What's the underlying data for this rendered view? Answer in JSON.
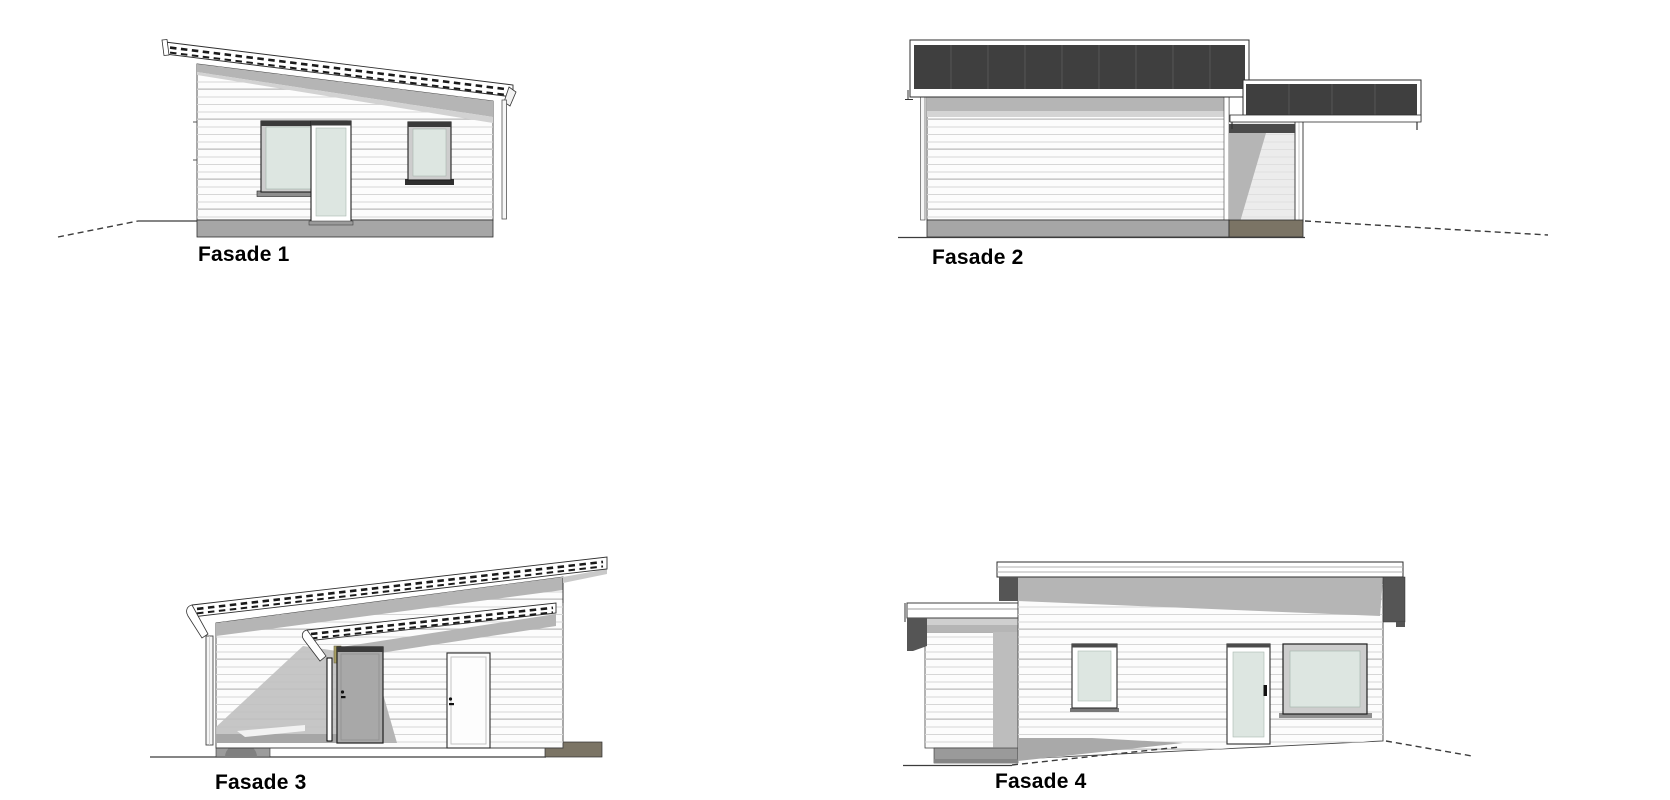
{
  "facades": [
    {
      "id": "fasade-1",
      "label": "Fasade 1",
      "view": "front elevation: mono-pitch roof sloping down to the right, large window, glazed door, small window, ground line falling away to the left"
    },
    {
      "id": "fasade-2",
      "label": "Fasade 2",
      "view": "side elevation: dark flat roof band, closed siding wall, attached carport with corner post at the right, ground line falling away to the right"
    },
    {
      "id": "fasade-3",
      "label": "Fasade 3",
      "view": "rear elevation: shed roof rising to the right, open carport with post at the left, grey entrance door and white door under a lower porch roof"
    },
    {
      "id": "fasade-4",
      "label": "Fasade 4",
      "view": "side elevation: attached carport at the left, small window, glazed door, large window, terrace slab in front"
    }
  ],
  "colors": {
    "background": "#ffffff",
    "wall": "#fcfcfc",
    "siding_line": "#d6d6d6",
    "roof_dark": "#3f3f3f",
    "shadow_grey": "#b5b5b5",
    "carport_shadow": "#c0c0c0",
    "plinth_grey": "#a6a6a6",
    "plinth_brown": "#7b7465",
    "glass_green": "#dde6e1",
    "frame_dark": "#3a3a3a",
    "door_grey": "#a8a8a8",
    "timber_post": "#a89f63",
    "line": "#3c3c3c",
    "label_text": "#000000"
  }
}
